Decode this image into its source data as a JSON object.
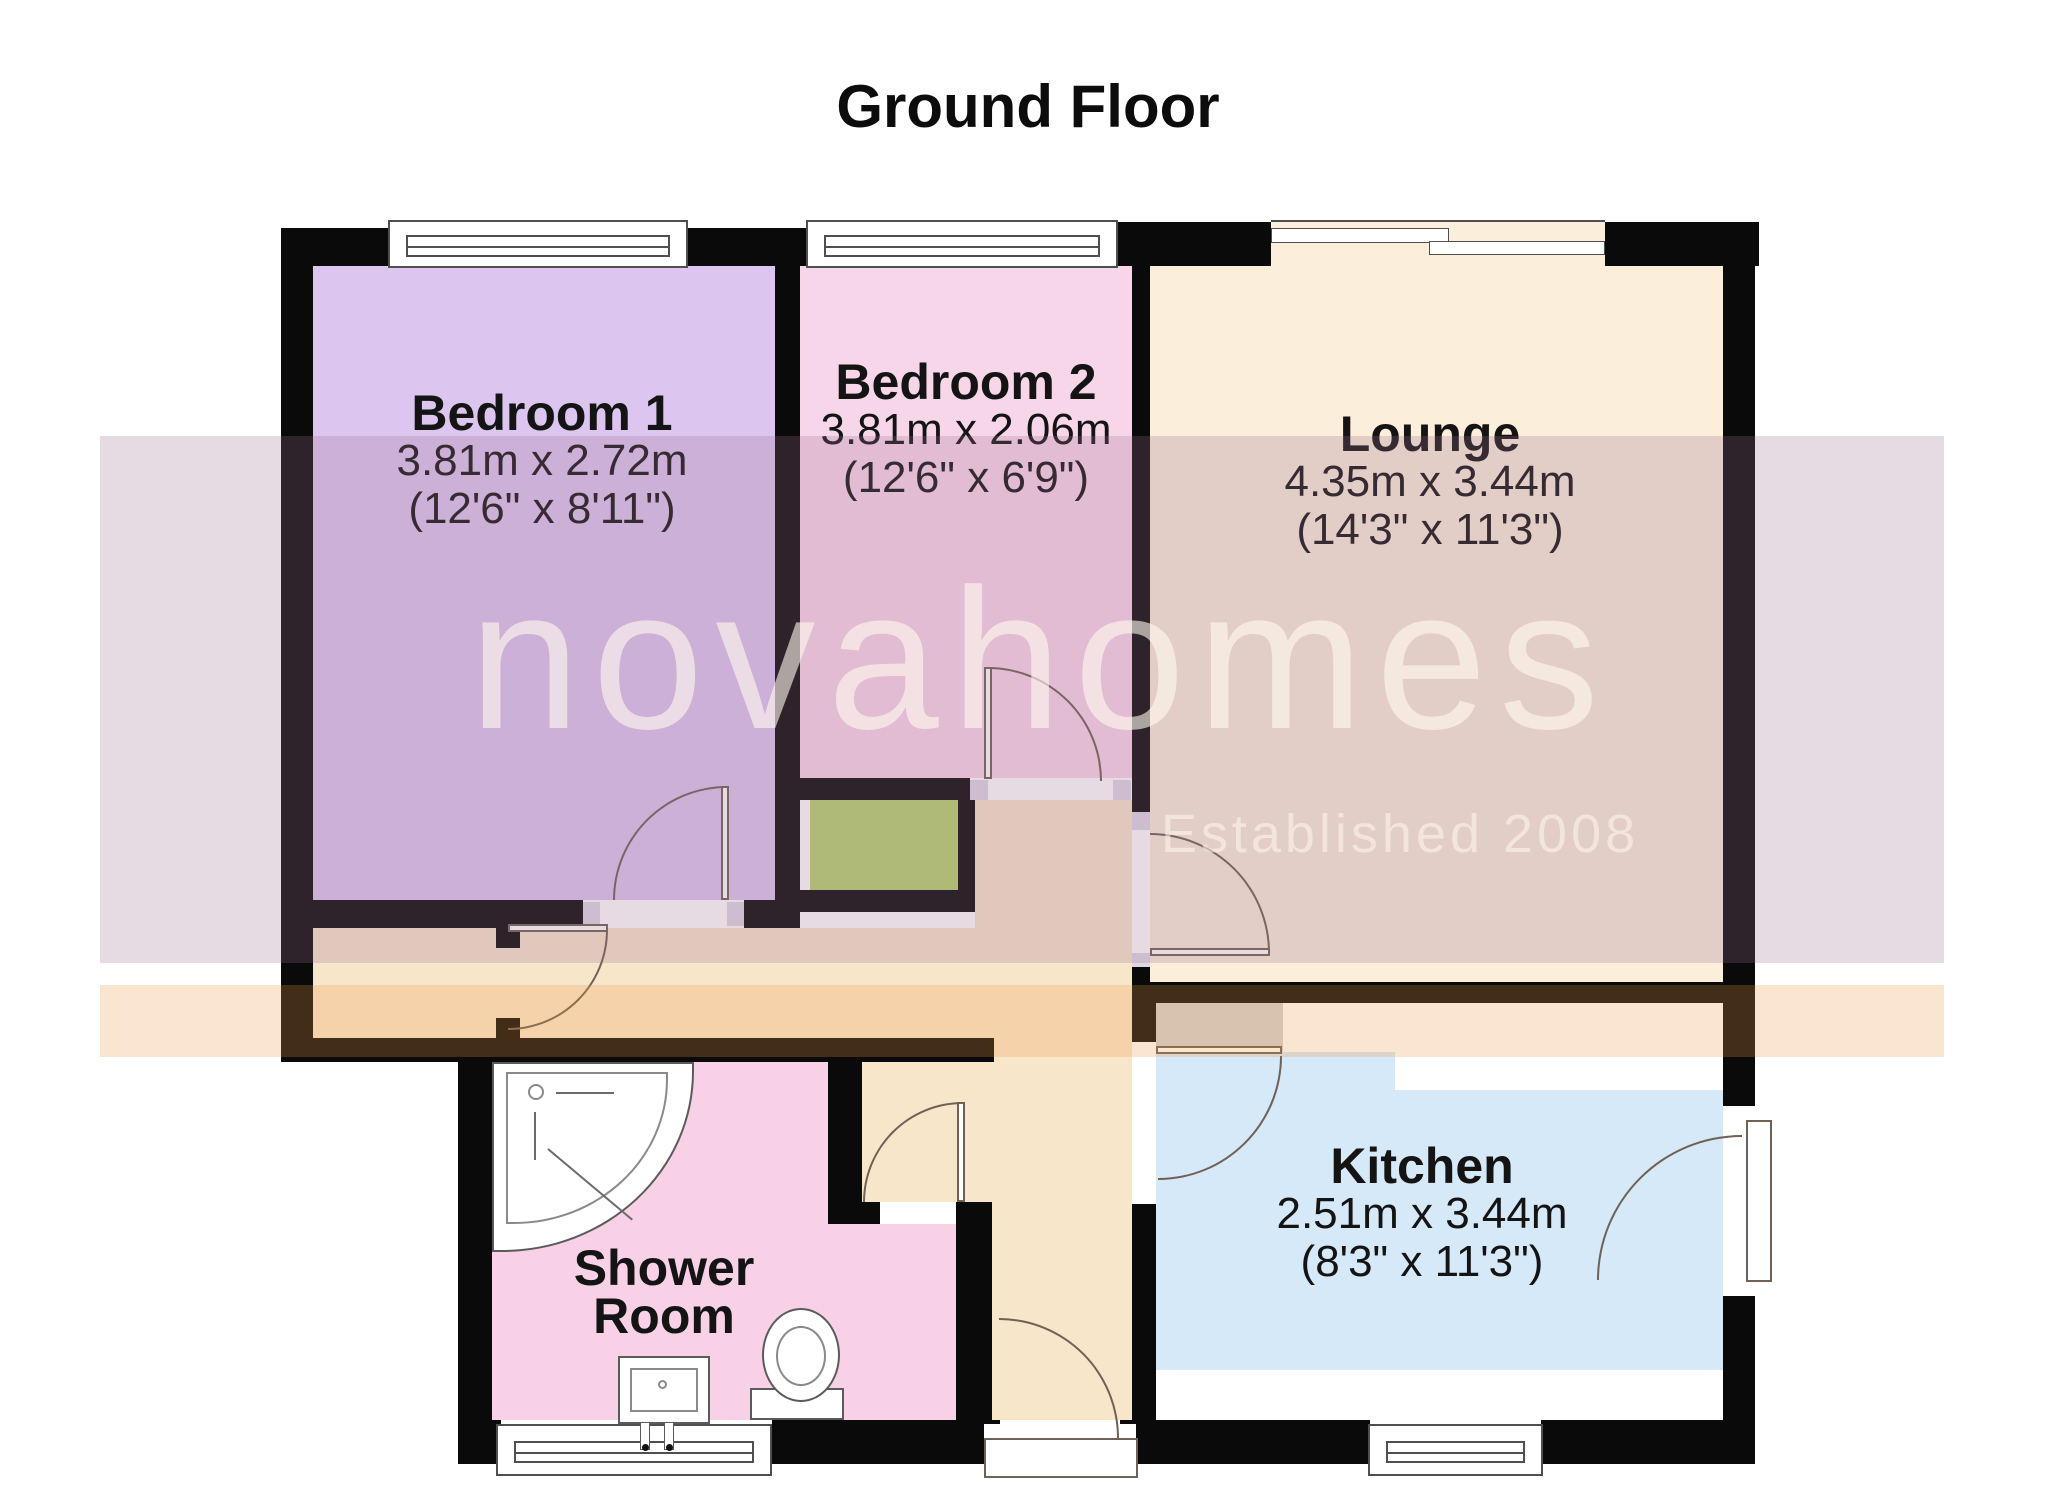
{
  "title": "Ground Floor",
  "watermark": {
    "brand": "novahomes",
    "tagline": "Established 2008"
  },
  "rooms": {
    "bedroom1": {
      "name": "Bedroom 1",
      "metric": "3.81m x 2.72m",
      "imperial": "(12'6\" x 8'11\")"
    },
    "bedroom2": {
      "name": "Bedroom 2",
      "metric": "3.81m x 2.06m",
      "imperial": "(12'6\" x 6'9\")"
    },
    "lounge": {
      "name": "Lounge",
      "metric": "4.35m x 3.44m",
      "imperial": "(14'3\" x 11'3\")"
    },
    "kitchen": {
      "name": "Kitchen",
      "metric": "2.51m x 3.44m",
      "imperial": "(8'3\" x 11'3\")"
    },
    "shower_room": {
      "name": "Shower Room"
    }
  },
  "colors": {
    "wall": "#0a0a0a",
    "arc": "#6f6156",
    "window_line": "#4f4f4f",
    "bedroom1_fill": "#dcc6f0",
    "bedroom2_fill": "#f8d6e9",
    "lounge_fill": "#fbeeda",
    "hall_fill": "#f8e6cb",
    "kitchen_fill": "#d6e9f8",
    "shower_fill": "#f8d1e7",
    "closet_fill": "#b6d36f",
    "counter_gray": "#d2d2d6",
    "counter_white": "#ffffff",
    "band_top": "rgba(156,112,144,0.25)",
    "band_bottom": "rgba(235,151,67,0.25)",
    "watermark_text": "rgba(255,250,238,0.60)",
    "tagline_text": "rgba(255,248,235,0.55)"
  }
}
